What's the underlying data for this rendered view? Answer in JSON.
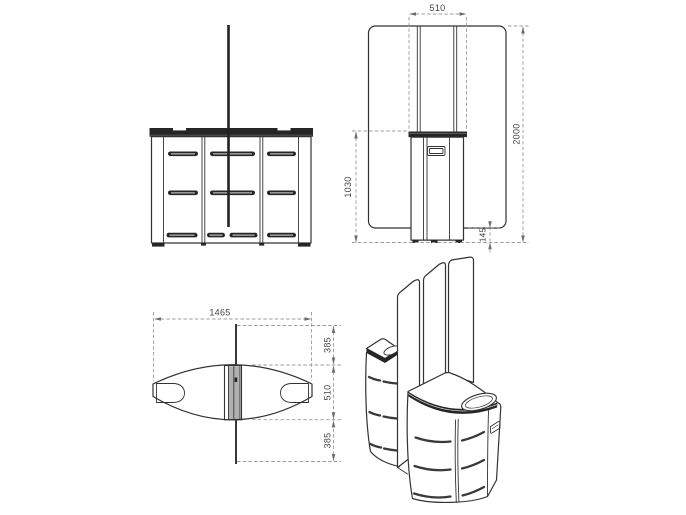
{
  "drawing": {
    "kind": "furniture technical drawing, four views"
  },
  "views": {
    "side": {
      "dim_panel_width": "510",
      "dim_total_height": "2000",
      "dim_counter_height": "1030",
      "dim_panel_floor_gap": "145"
    },
    "plan": {
      "dim_length": "1465",
      "dim_back_extension": "385",
      "dim_counter_depth": "510",
      "dim_front_extension": "385"
    }
  },
  "colors": {
    "line": "#333333",
    "dim_line": "#9b9b9b",
    "dim_text": "#444444",
    "fill_dark": "#262626",
    "fill_gray": "#b0b0b0",
    "background": "#ffffff"
  }
}
